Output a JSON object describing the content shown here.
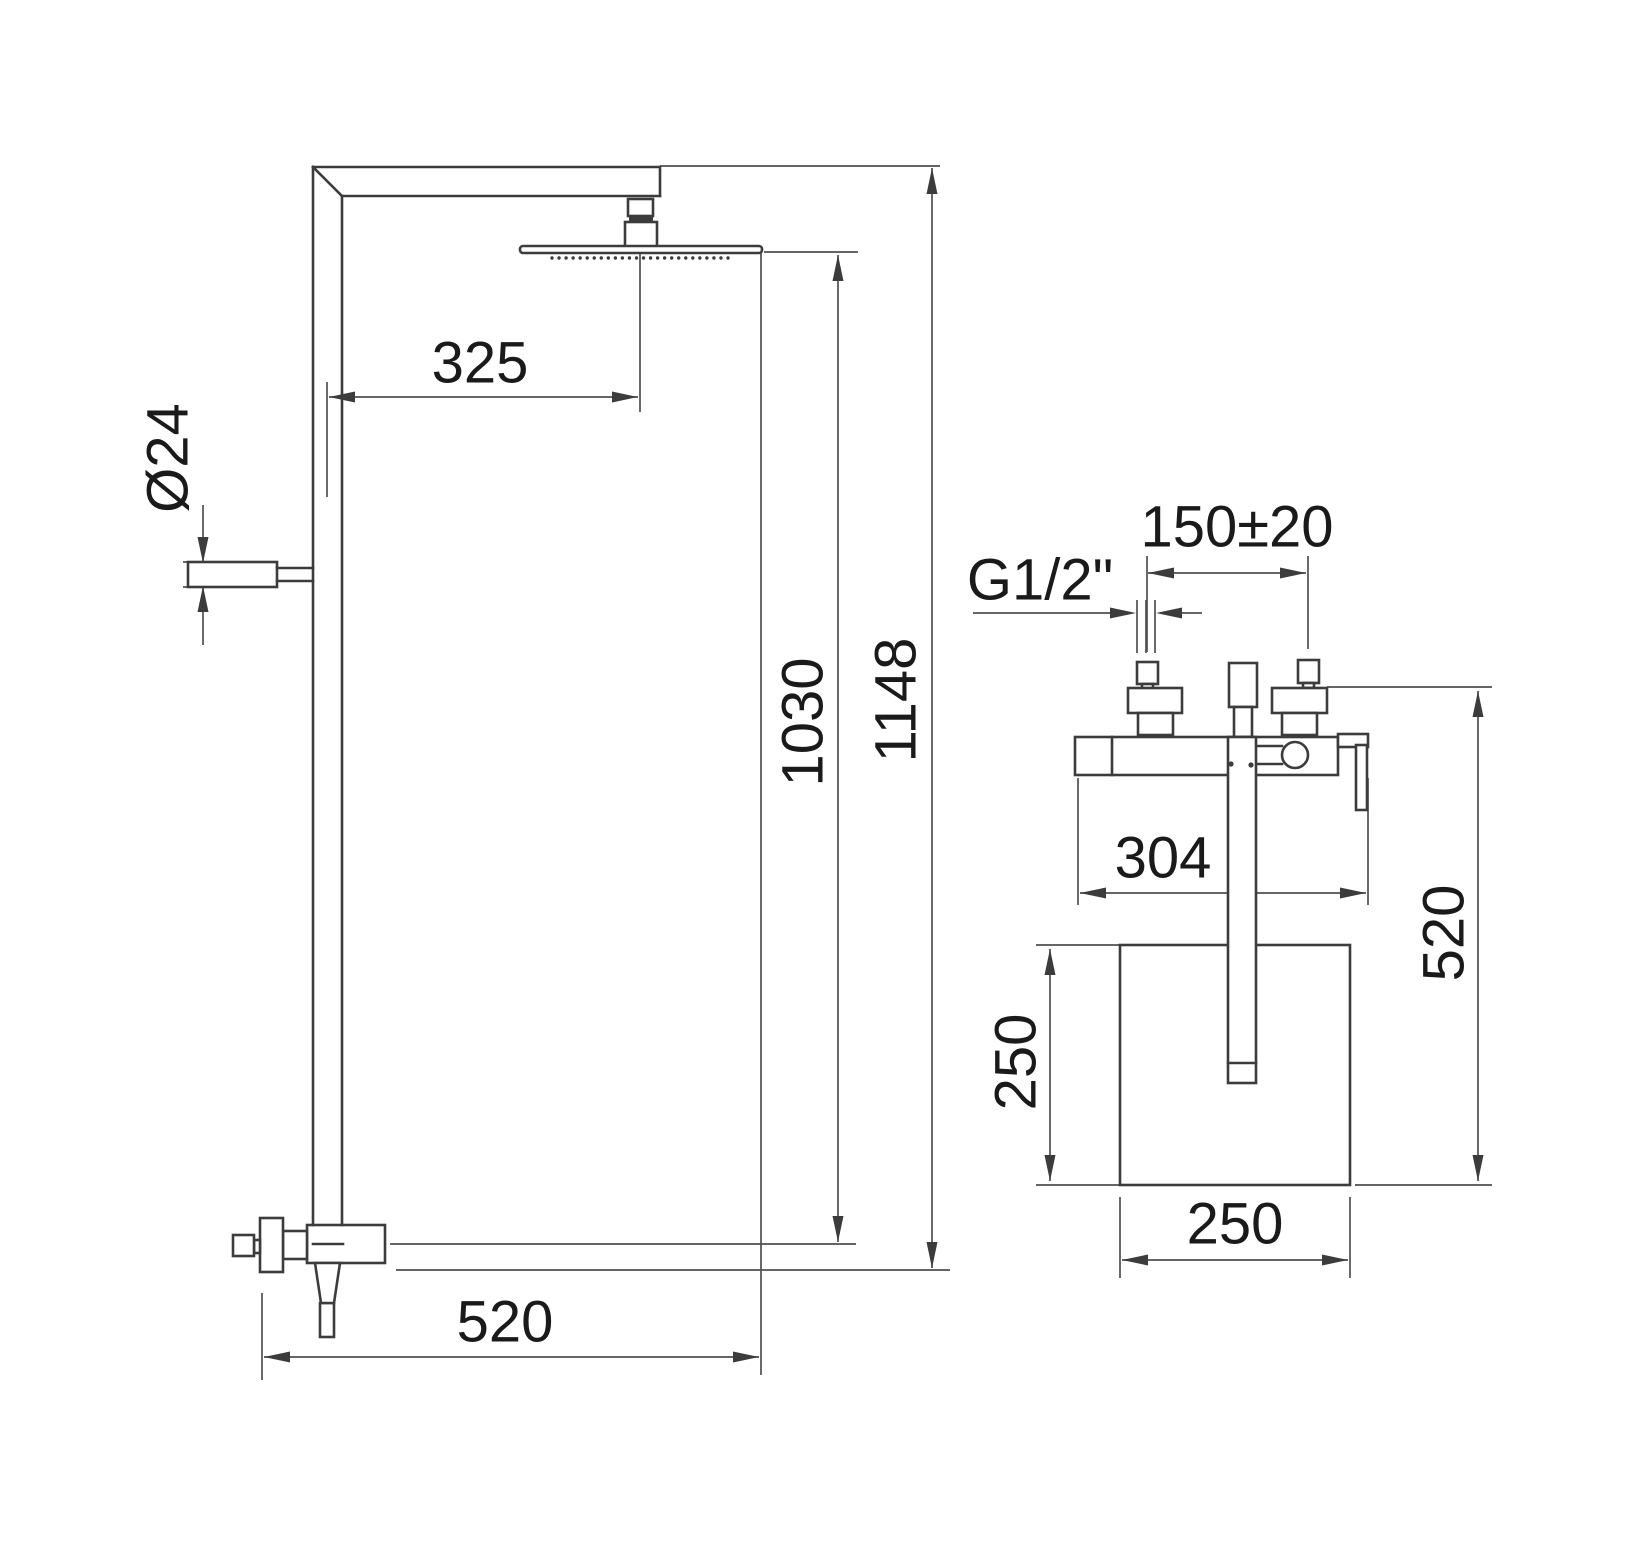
{
  "meta": {
    "canvas_w": 1650,
    "canvas_h": 1550,
    "bg_color": "#ffffff",
    "object_color": "#3c3c3c",
    "dim_color": "#4f4f4f",
    "text_color": "#1a1a1a",
    "font_size": 58,
    "object_stroke": 2.6,
    "thin_stroke": 2.0,
    "dim_stroke": 1.7,
    "arrow_len": 26,
    "arrow_half_w": 5.5
  },
  "labels": [
    {
      "id": "head-offset-325",
      "text": "325",
      "x": 480,
      "y": 363,
      "rot": 0
    },
    {
      "id": "bracket-diameter-24",
      "text": "Ø24",
      "x": 168,
      "y": 458,
      "rot": -90
    },
    {
      "id": "bottom-projection-520",
      "text": "520",
      "x": 505,
      "y": 1322,
      "rot": 0
    },
    {
      "id": "height-to-head-1030",
      "text": "1030",
      "x": 803,
      "y": 722,
      "rot": -90
    },
    {
      "id": "overall-height-1148",
      "text": "1148",
      "x": 896,
      "y": 700,
      "rot": -90
    },
    {
      "id": "inlet-spacing-150",
      "text": "150±20",
      "x": 1237,
      "y": 527,
      "rot": 0
    },
    {
      "id": "thread-size-g12",
      "text": "G1/2\"",
      "x": 1040,
      "y": 580,
      "rot": 0
    },
    {
      "id": "body-width-304",
      "text": "304",
      "x": 1163,
      "y": 858,
      "rot": 0
    },
    {
      "id": "side-height-520",
      "text": "520",
      "x": 1444,
      "y": 933,
      "rot": -90
    },
    {
      "id": "tray-height-250",
      "text": "250",
      "x": 1016,
      "y": 1062,
      "rot": -90
    },
    {
      "id": "tray-width-250",
      "text": "250",
      "x": 1235,
      "y": 1224,
      "rot": 0
    }
  ],
  "dim_lines": [
    {
      "id": "top-extension",
      "pts": [
        660,
        166,
        940,
        166
      ]
    },
    {
      "id": "offset-ext-left",
      "pts": [
        327,
        382,
        327,
        497
      ]
    },
    {
      "id": "offset-ext-right",
      "pts": [
        640,
        252,
        640,
        412
      ]
    },
    {
      "id": "offset-dim-line",
      "pts": [
        329,
        397,
        638,
        397
      ]
    },
    {
      "id": "diam-ext-top",
      "pts": [
        183,
        562,
        258,
        562
      ]
    },
    {
      "id": "diam-ext-bottom",
      "pts": [
        183,
        587,
        258,
        587
      ]
    },
    {
      "id": "diam-dim-upper",
      "pts": [
        203,
        505,
        203,
        562
      ]
    },
    {
      "id": "diam-dim-lower",
      "pts": [
        203,
        587,
        203,
        645
      ]
    },
    {
      "id": "projection-ext-left",
      "pts": [
        262,
        1293,
        262,
        1380
      ]
    },
    {
      "id": "projection-dim-line",
      "pts": [
        264,
        1357,
        759,
        1357
      ]
    },
    {
      "id": "projection-ext-right",
      "pts": [
        761,
        252,
        761,
        1375
      ]
    },
    {
      "id": "head-level-ext",
      "pts": [
        764,
        252,
        858,
        252
      ]
    },
    {
      "id": "valve-center-ext",
      "pts": [
        390,
        1244,
        856,
        1244
      ]
    },
    {
      "id": "valve-bottom-ext",
      "pts": [
        396,
        1270,
        950,
        1270
      ]
    },
    {
      "id": "height-1030-dim-line",
      "pts": [
        838,
        255,
        838,
        1242
      ]
    },
    {
      "id": "height-1148-dim-line",
      "pts": [
        932,
        168,
        932,
        1268
      ]
    },
    {
      "id": "spacing-ext-left",
      "pts": [
        1147,
        556,
        1147,
        652
      ]
    },
    {
      "id": "spacing-ext-right",
      "pts": [
        1308,
        556,
        1308,
        649
      ]
    },
    {
      "id": "spacing-dim-line",
      "pts": [
        1148,
        573,
        1306,
        573
      ]
    },
    {
      "id": "thread-leader-left",
      "pts": [
        973,
        613,
        1128,
        613
      ]
    },
    {
      "id": "thread-leader-right",
      "pts": [
        1164,
        613,
        1202,
        613
      ]
    },
    {
      "id": "thread-tick-1",
      "pts": [
        1137,
        600,
        1137,
        653
      ]
    },
    {
      "id": "thread-tick-2",
      "pts": [
        1146,
        600,
        1146,
        653
      ]
    },
    {
      "id": "thread-tick-3",
      "pts": [
        1155,
        600,
        1155,
        653
      ]
    },
    {
      "id": "body-ext-left",
      "pts": [
        1078,
        778,
        1078,
        905
      ]
    },
    {
      "id": "body-ext-right",
      "pts": [
        1368,
        778,
        1368,
        905
      ]
    },
    {
      "id": "body-dim-line",
      "pts": [
        1080,
        893,
        1366,
        893
      ]
    },
    {
      "id": "side-height-ext-top",
      "pts": [
        1327,
        687,
        1492,
        687
      ]
    },
    {
      "id": "side-height-ext-bottom",
      "pts": [
        1355,
        1185,
        1492,
        1185
      ]
    },
    {
      "id": "side-height-dim-line",
      "pts": [
        1478,
        691,
        1478,
        1181
      ]
    },
    {
      "id": "tray-ext-top",
      "pts": [
        1036,
        945,
        1120,
        945
      ]
    },
    {
      "id": "tray-ext-bottom",
      "pts": [
        1036,
        1185,
        1120,
        1185
      ]
    },
    {
      "id": "tray-height-dim-line",
      "pts": [
        1050,
        949,
        1050,
        1181
      ]
    },
    {
      "id": "tray-width-ext-left",
      "pts": [
        1120,
        1197,
        1120,
        1278
      ]
    },
    {
      "id": "tray-width-ext-right",
      "pts": [
        1350,
        1197,
        1350,
        1278
      ]
    },
    {
      "id": "tray-width-dim-line",
      "pts": [
        1122,
        1260,
        1348,
        1260
      ]
    }
  ],
  "arrows": [
    {
      "x": 329,
      "y": 397,
      "dir": "left"
    },
    {
      "x": 638,
      "y": 397,
      "dir": "right"
    },
    {
      "x": 203,
      "y": 563,
      "dir": "down"
    },
    {
      "x": 203,
      "y": 586,
      "dir": "up"
    },
    {
      "x": 264,
      "y": 1357,
      "dir": "left"
    },
    {
      "x": 759,
      "y": 1357,
      "dir": "right"
    },
    {
      "x": 838,
      "y": 255,
      "dir": "up"
    },
    {
      "x": 838,
      "y": 1242,
      "dir": "down"
    },
    {
      "x": 932,
      "y": 168,
      "dir": "up"
    },
    {
      "x": 932,
      "y": 1268,
      "dir": "down"
    },
    {
      "x": 1148,
      "y": 573,
      "dir": "left"
    },
    {
      "x": 1306,
      "y": 573,
      "dir": "right"
    },
    {
      "x": 1136,
      "y": 613,
      "dir": "right"
    },
    {
      "x": 1156,
      "y": 613,
      "dir": "left"
    },
    {
      "x": 1080,
      "y": 893,
      "dir": "left"
    },
    {
      "x": 1366,
      "y": 893,
      "dir": "right"
    },
    {
      "x": 1478,
      "y": 691,
      "dir": "up"
    },
    {
      "x": 1478,
      "y": 1181,
      "dir": "down"
    },
    {
      "x": 1050,
      "y": 949,
      "dir": "up"
    },
    {
      "x": 1050,
      "y": 1181,
      "dir": "down"
    },
    {
      "x": 1122,
      "y": 1260,
      "dir": "left"
    },
    {
      "x": 1348,
      "y": 1260,
      "dir": "right"
    }
  ],
  "object_rects": [
    {
      "id": "head-connector-nut",
      "x": 628,
      "y": 199,
      "w": 25,
      "h": 17
    },
    {
      "id": "head-connector-base",
      "x": 625,
      "y": 222,
      "w": 32,
      "h": 25
    },
    {
      "id": "shower-head-plate",
      "x": 520,
      "y": 246,
      "w": 242,
      "h": 7,
      "rx": 3
    },
    {
      "id": "wall-bracket-stub",
      "x": 188,
      "y": 562,
      "w": 89,
      "h": 25
    },
    {
      "id": "diverter-valve-body",
      "x": 307,
      "y": 1225,
      "w": 78,
      "h": 38
    },
    {
      "id": "diverter-mid-piece",
      "x": 283,
      "y": 1231,
      "w": 24,
      "h": 28
    },
    {
      "id": "diverter-knob-body",
      "x": 260,
      "y": 1218,
      "w": 23,
      "h": 54
    },
    {
      "id": "diverter-knob-stem",
      "x": 254,
      "y": 1240,
      "w": 6,
      "h": 13
    },
    {
      "id": "diverter-knob",
      "x": 233,
      "y": 1235,
      "w": 21,
      "h": 21
    },
    {
      "id": "outlet-stub",
      "x": 320,
      "y": 1303,
      "w": 14,
      "h": 34
    },
    {
      "id": "left-inlet-nut",
      "x": 1137,
      "y": 662,
      "w": 21,
      "h": 22
    },
    {
      "id": "left-inlet-stem",
      "x": 1142,
      "y": 684,
      "w": 11,
      "h": 5
    },
    {
      "id": "left-inlet-block",
      "x": 1128,
      "y": 688,
      "w": 54,
      "h": 25
    },
    {
      "id": "left-inlet-neck",
      "x": 1138,
      "y": 713,
      "w": 35,
      "h": 22
    },
    {
      "id": "right-inlet-nut",
      "x": 1298,
      "y": 660,
      "w": 21,
      "h": 23
    },
    {
      "id": "right-inlet-stem",
      "x": 1303,
      "y": 683,
      "w": 11,
      "h": 5
    },
    {
      "id": "right-inlet-block",
      "x": 1272,
      "y": 688,
      "w": 55,
      "h": 25
    },
    {
      "id": "right-inlet-neck",
      "x": 1282,
      "y": 713,
      "w": 35,
      "h": 22
    },
    {
      "id": "handshower-grip",
      "x": 1229,
      "y": 663,
      "w": 28,
      "h": 44
    },
    {
      "id": "handshower-neck",
      "x": 1234,
      "y": 707,
      "w": 18,
      "h": 30
    },
    {
      "id": "mixer-body-bar",
      "x": 1075,
      "y": 737,
      "w": 263,
      "h": 38
    },
    {
      "id": "mixer-lever-top",
      "x": 1338,
      "y": 734,
      "w": 30,
      "h": 13
    },
    {
      "id": "mixer-lever-drop",
      "x": 1356,
      "y": 745,
      "w": 11,
      "h": 65
    },
    {
      "id": "mounting-square",
      "x": 1120,
      "y": 945,
      "w": 230,
      "h": 240
    },
    {
      "id": "handshower-wand",
      "x": 1228,
      "y": 737,
      "w": 28,
      "h": 346
    }
  ],
  "filled_rects": [
    {
      "id": "head-connector-seal",
      "x": 629,
      "y": 215,
      "w": 24,
      "h": 7
    }
  ],
  "object_lines": [
    {
      "id": "arm-top-edge",
      "pts": [
        313,
        167,
        658,
        167
      ]
    },
    {
      "id": "riser-left-edge",
      "pts": [
        313,
        167,
        313,
        1225
      ]
    },
    {
      "id": "corner-chamfer",
      "pts": [
        313,
        167,
        342,
        196
      ]
    },
    {
      "id": "riser-right-edge",
      "pts": [
        342,
        196,
        342,
        1225
      ]
    },
    {
      "id": "arm-bottom-edge",
      "pts": [
        342,
        196,
        660,
        196
      ]
    },
    {
      "id": "arm-end-edge",
      "pts": [
        660,
        167,
        660,
        196
      ]
    },
    {
      "id": "valve-inner-dash",
      "pts": [
        313,
        1244,
        343,
        1244
      ]
    },
    {
      "id": "bracket-neck-top",
      "pts": [
        277,
        568,
        313,
        568
      ]
    },
    {
      "id": "bracket-neck-bottom",
      "pts": [
        277,
        581,
        313,
        581
      ]
    },
    {
      "id": "mixer-endcap-line",
      "pts": [
        1112,
        737,
        1112,
        775
      ]
    },
    {
      "id": "ball-link-top",
      "pts": [
        1257,
        746,
        1282,
        746
      ]
    },
    {
      "id": "ball-link-bottom",
      "pts": [
        1257,
        764,
        1282,
        764
      ]
    },
    {
      "id": "wand-tip-line",
      "pts": [
        1228,
        1063,
        1256,
        1063
      ]
    }
  ],
  "polygons": [
    {
      "id": "outlet-taper",
      "pts": [
        [
          315,
          1263
        ],
        [
          340,
          1263
        ],
        [
          334,
          1303
        ],
        [
          321,
          1303
        ]
      ]
    }
  ],
  "circles": [
    {
      "id": "mixer-ball-joint",
      "cx": 1295,
      "cy": 755,
      "r": 13
    }
  ],
  "dots": [
    {
      "id": "mixer-screw-left",
      "cx": 1231,
      "cy": 764,
      "r": 2.6
    },
    {
      "id": "mixer-screw-right",
      "cx": 1251,
      "cy": 765,
      "r": 2.6
    }
  ],
  "nozzle_row": {
    "y": 258,
    "x1": 552,
    "x2": 728,
    "count": 26,
    "r": 1.7
  }
}
